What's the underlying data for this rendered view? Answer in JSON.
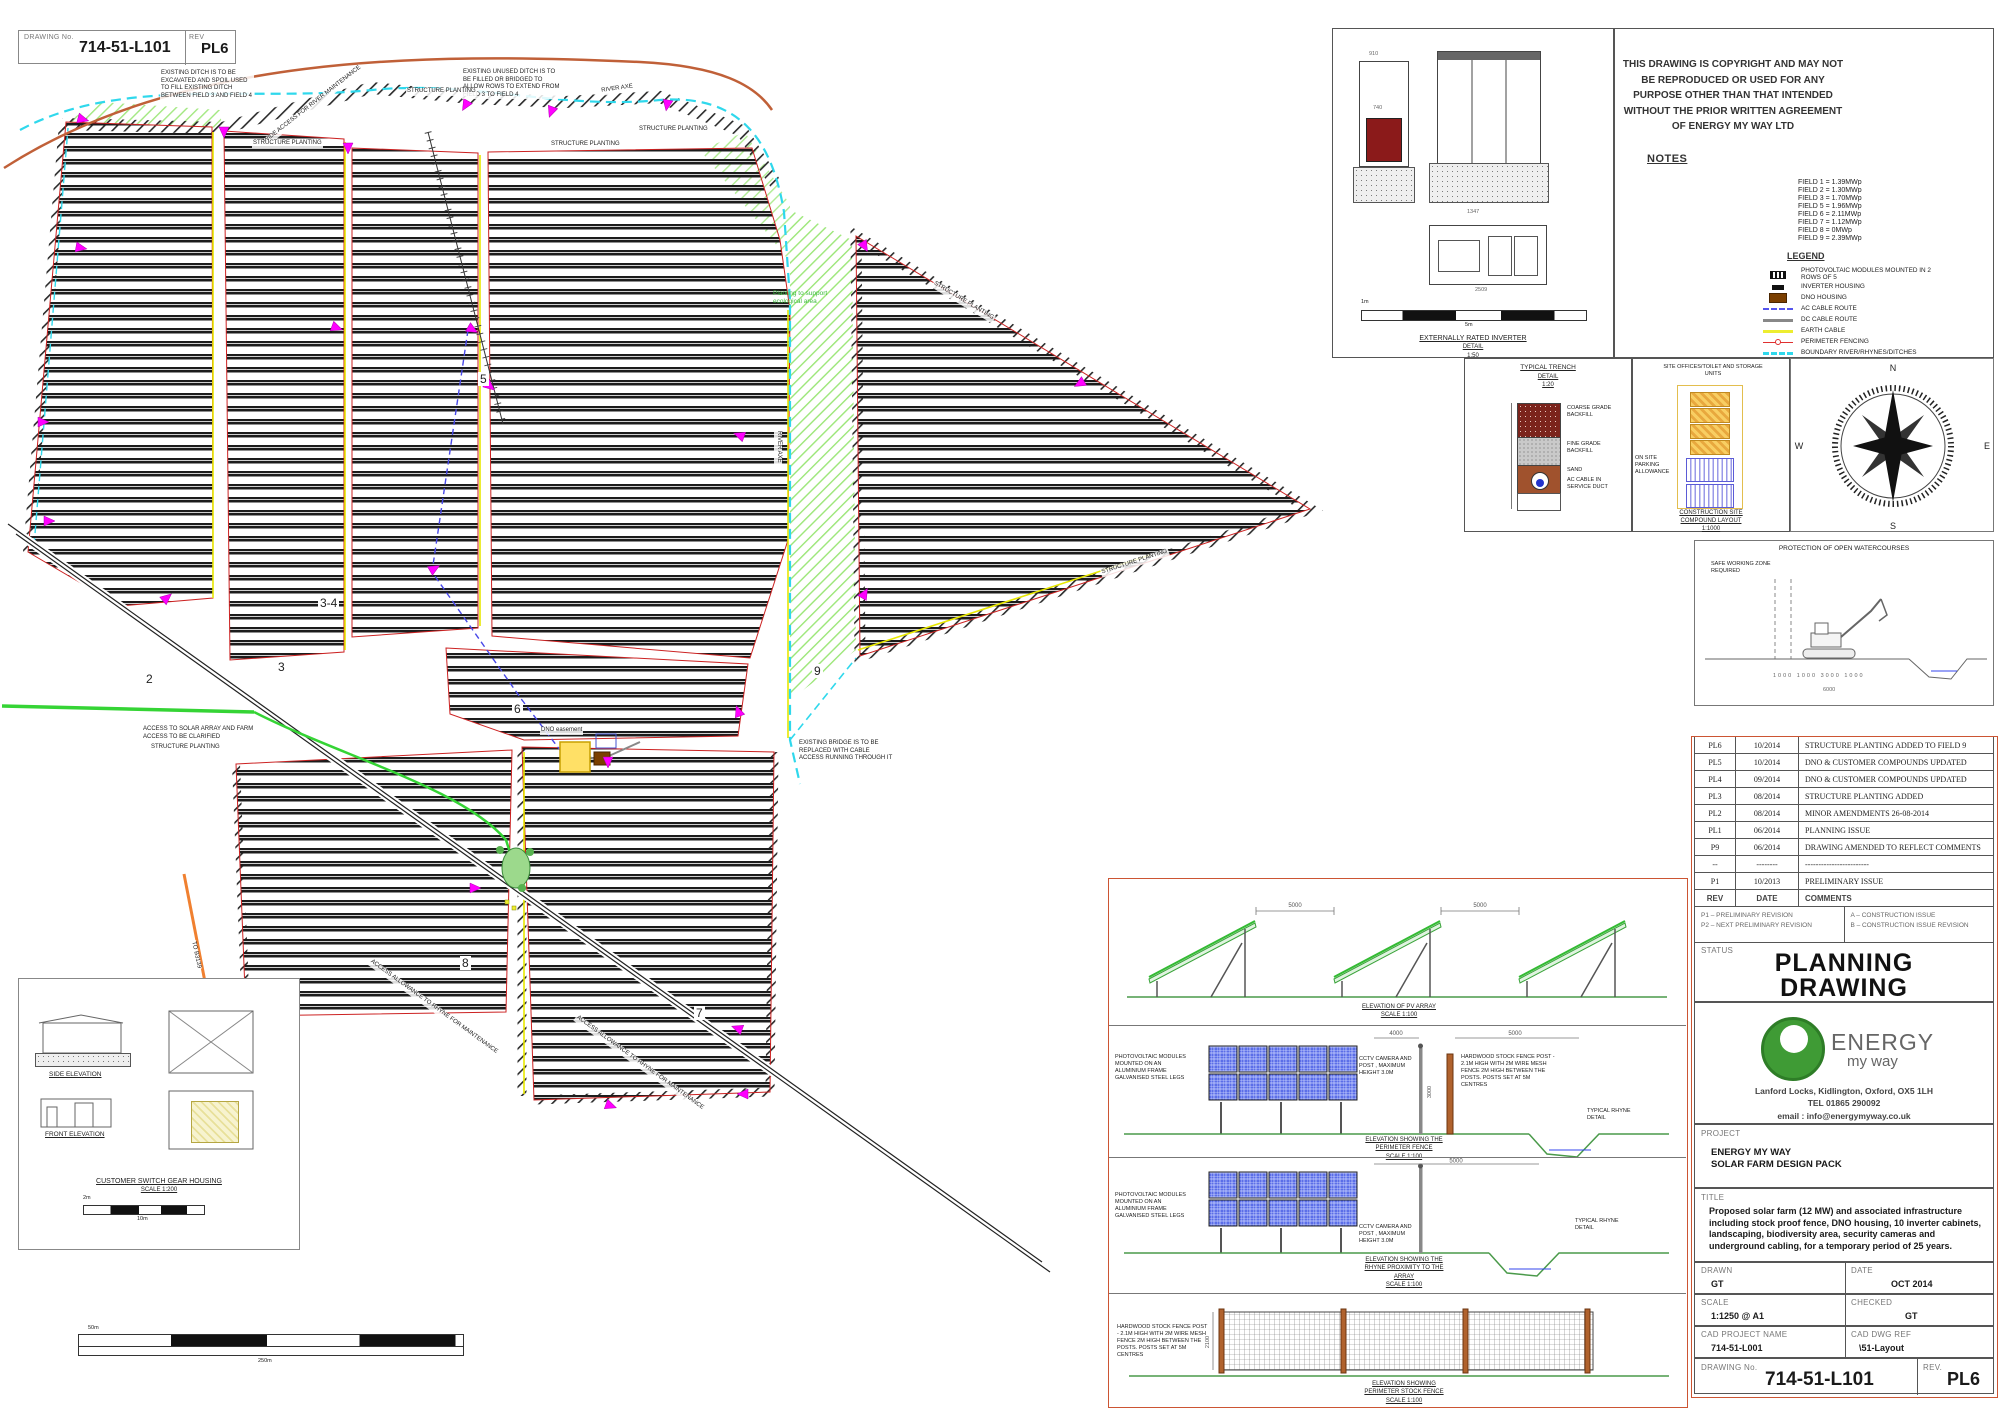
{
  "top_block": {
    "drawing_no_label": "DRAWING No.",
    "drawing_no": "714-51-L101",
    "rev_label": "REV",
    "rev": "PL6"
  },
  "colors": {
    "cctv": "#FF00FF",
    "perimeter_fence": "#E03030",
    "boundary": "#2FD8EC",
    "earth_cable": "#F2F20A",
    "farm_access": "#35D435",
    "shared_access": "#F08030",
    "public_right_of_way": "#C06038",
    "dno_housing": "#7B3F00",
    "pv_module": "#5B6EE8",
    "logo_green": "#3F9B35",
    "titleblock_border": "#CC5533"
  },
  "map": {
    "field_labels": [
      "2",
      "3",
      "3-4",
      "5",
      "6",
      "7",
      "8",
      "9"
    ],
    "annotations": {
      "ditch_excavated": "EXISTING DITCH IS TO BE EXCAVATED AND SPOIL USED TO FILL EXISTING DITCH BETWEEN FIELD 3 AND FIELD 4",
      "ditch_filled": "EXISTING UNUSED DITCH IS TO BE FILLED OR BRIDGED TO ALLOW ROWS TO EXTEND FROM FIELD 3 TO FIELD 4",
      "river_access": "WIDE ACCESS FOR RIVER MAINTENANCE",
      "structure_planting": "STRUCTURE PLANTING",
      "river_axe": "RIVER AXE",
      "eco_area": "Planting to support ecological area",
      "access_clarified": "ACCESS TO SOLAR ARRAY AND FARM ACCESS TO BE CLARIFIED",
      "bridge": "EXISTING BRIDGE IS TO BE REPLACED WITH CABLE ACCESS RUNNING THROUGH IT",
      "dno_easement": "DNO easement",
      "rhyne_access": "ACCESS ALLOWANCE TO RHYNE FOR MAINTENANCE",
      "to_road": "TO B3139"
    },
    "scale_bar": {
      "top": "50m",
      "bottom": "250m"
    }
  },
  "inverter_detail": {
    "dim_a": "910",
    "dim_b": "740",
    "dim_c": "1347",
    "dim_d": "2509",
    "scale_top": "1m",
    "scale_bottom": "5m",
    "caption_line1": "EXTERNALLY RATED INVERTER",
    "caption_line2": "DETAIL",
    "caption_line3": "1:50"
  },
  "trench_detail": {
    "title_line1": "TYPICAL TRENCH",
    "title_line2": "DETAIL",
    "title_line3": "1:20",
    "layer_coarse": "COARSE GRADE BACKFILL",
    "layer_fine": "FINE GRADE BACKFILL",
    "layer_sand": "SAND",
    "layer_cable": "AC CABLE IN SERVICE DUCT"
  },
  "compound_detail": {
    "units_label": "SITE OFFICES/TOILET AND STORAGE UNITS",
    "parking_label": "ON SITE PARKING ALLOWANCE",
    "caption_line1": "CONSTRUCTION SITE",
    "caption_line2": "COMPOUND LAYOUT",
    "caption_line3": "1:1000"
  },
  "compass": {
    "north": "N",
    "east": "E",
    "south": "S",
    "west": "W"
  },
  "watercourse_detail": {
    "heading": "PROTECTION OF OPEN WATERCOURSES",
    "zone_label": "SAFE WORKING ZONE REQUIRED",
    "dims": [
      "1000",
      "1000",
      "3000",
      "1000"
    ],
    "dim_total": "6000"
  },
  "copyright_notice": "THIS DRAWING IS COPYRIGHT AND MAY NOT BE REPRODUCED OR USED FOR ANY PURPOSE OTHER THAN THAT INTENDED WITHOUT THE PRIOR WRITTEN AGREEMENT OF ENERGY MY WAY LTD",
  "notes": {
    "heading": "NOTES",
    "field_outputs": [
      "FIELD 1 = 1.39MWp",
      "FIELD 2 = 1.30MWp",
      "FIELD 3 = 1.70MWp",
      "FIELD 5 = 1.96MWp",
      "FIELD 6 = 2.11MWp",
      "FIELD 7 = 1.12MWp",
      "FIELD 8 = 0MWp",
      "FIELD 9 = 2.39MWp"
    ]
  },
  "legend": {
    "heading": "LEGEND",
    "items": {
      "pv": "PHOTOVOLTAIC MODULES MOUNTED IN 2 ROWS OF 5",
      "inverter": "INVERTER HOUSING",
      "dno": "DNO HOUSING",
      "ac": "AC CABLE ROUTE",
      "dc": "DC CABLE ROUTE",
      "earth": "EARTH CABLE",
      "fence": "PERIMETER FENCING",
      "boundary": "BOUNDARY RIVER/RHYNES/DITCHES",
      "prow": "PUBLIC RIGHT OF WAY",
      "shared": "SHARED ACCESS",
      "farm": "FARM & SOLAR PARK ACCESS",
      "cctv": "CCTV CAMERA LOCATION",
      "gate": "SECURE ACCESS GATE",
      "bee": "BEE HIVES"
    }
  },
  "revisions": {
    "header": {
      "rev": "REV",
      "date": "DATE",
      "comments": "COMMENTS"
    },
    "rows": [
      {
        "rev": "PL6",
        "date": "10/2014",
        "comment": "STRUCTURE PLANTING ADDED TO FIELD 9"
      },
      {
        "rev": "PL5",
        "date": "10/2014",
        "comment": "DNO & CUSTOMER COMPOUNDS UPDATED"
      },
      {
        "rev": "PL4",
        "date": "09/2014",
        "comment": "DNO & CUSTOMER COMPOUNDS UPDATED"
      },
      {
        "rev": "PL3",
        "date": "08/2014",
        "comment": "STRUCTURE PLANTING ADDED"
      },
      {
        "rev": "PL2",
        "date": "08/2014",
        "comment": "MINOR AMENDMENTS 26-08-2014"
      },
      {
        "rev": "PL1",
        "date": "06/2014",
        "comment": "PLANNING ISSUE"
      },
      {
        "rev": "P9",
        "date": "06/2014",
        "comment": "DRAWING AMENDED TO REFLECT COMMENTS"
      },
      {
        "rev": "--",
        "date": "--------",
        "comment": "------------------------"
      },
      {
        "rev": "P1",
        "date": "10/2013",
        "comment": "PRELIMINARY ISSUE"
      }
    ],
    "key_p1": "P1 – PRELIMINARY REVISION",
    "key_p2": "P2 – NEXT PRELIMINARY REVISION",
    "key_a": "A – CONSTRUCTION ISSUE",
    "key_b": "B – CONSTRUCTION ISSUE REVISION"
  },
  "status": {
    "label": "STATUS",
    "line1": "PLANNING",
    "line2": "DRAWING"
  },
  "company": {
    "brand": "ENERGY",
    "brand_sub": "my way",
    "address": "Lanford Locks, Kidlington, Oxford, OX5 1LH",
    "tel": "TEL 01865 290092",
    "email": "email : info@energymyway.co.uk"
  },
  "project": {
    "label": "PROJECT",
    "line1": "ENERGY MY WAY",
    "line2": "SOLAR FARM DESIGN PACK"
  },
  "title_box": {
    "label": "TITLE",
    "text": "Proposed solar farm (12 MW) and associated infrastructure including stock proof fence, DNO housing, 10 inverter cabinets, landscaping, biodiversity area, security cameras and underground cabling, for a temporary period of 25 years."
  },
  "info": {
    "drawn_label": "DRAWN",
    "drawn": "GT",
    "date_label": "DATE",
    "date": "OCT 2014",
    "scale_label": "SCALE",
    "scale": "1:1250 @ A1",
    "checked_label": "CHECKED",
    "checked": "GT",
    "cad_name_label": "CAD PROJECT NAME",
    "cad_name": "714-51-L001",
    "cad_ref_label": "CAD DWG REF",
    "cad_ref": "\\51-Layout",
    "drawing_no_label": "DRAWING No.",
    "drawing_no": "714-51-L101",
    "rev_label": "REV.",
    "rev": "PL6"
  },
  "elevations": {
    "modules_label": "PHOTOVOLTAIC MODULES MOUNTED ON AN ALUMINIUM FRAME GALVANISED STEEL LEGS",
    "cctv_label": "CCTV CAMERA AND POST , MAXIMUM HEIGHT 3.0M",
    "fence_post_label": "HARDWOOD STOCK FENCE POST - 2.1M HIGH WITH 2M WIRE MESH FENCE 2M HIGH BETWEEN THE POSTS.  POSTS SET AT 5M CENTRES",
    "rhyne_label": "TYPICAL RHYNE DETAIL",
    "pv_array": {
      "dim": "5000",
      "caption_line1": "ELEVATION OF PV ARRAY",
      "caption_line2": "SCALE 1:100"
    },
    "perimeter_fence": {
      "dim_a": "4000",
      "dim_b": "5000",
      "dim_post": "3000",
      "caption_line1": "ELEVATION SHOWING THE",
      "caption_line2": "PERIMETER FENCE",
      "caption_line3": "SCALE 1:100"
    },
    "rhyne_proximity": {
      "dim": "5000",
      "caption_line1": "ELEVATION SHOWING THE",
      "caption_line2": "RHYNE PROXIMITY TO THE",
      "caption_line3": "ARRAY",
      "caption_line4": "SCALE 1:100"
    },
    "stock_fence": {
      "dim": "2100",
      "post_label": "HARDWOOD STOCK FENCE POST - 2.1M HIGH WITH 2M WIRE MESH FENCE 2M HIGH BETWEEN THE POSTS. POSTS SET AT 5M CENTRES",
      "caption_line1": "ELEVATION SHOWING",
      "caption_line2": "PERIMETER STOCK FENCE",
      "caption_line3": "SCALE 1:100"
    }
  },
  "switchgear": {
    "side_caption": "SIDE ELEVATION",
    "front_caption": "FRONT ELEVATION",
    "caption_line1": "CUSTOMER SWITCH GEAR HOUSING",
    "caption_line2": "SCALE 1:200",
    "scale_top": "2m",
    "scale_bottom": "10m"
  }
}
